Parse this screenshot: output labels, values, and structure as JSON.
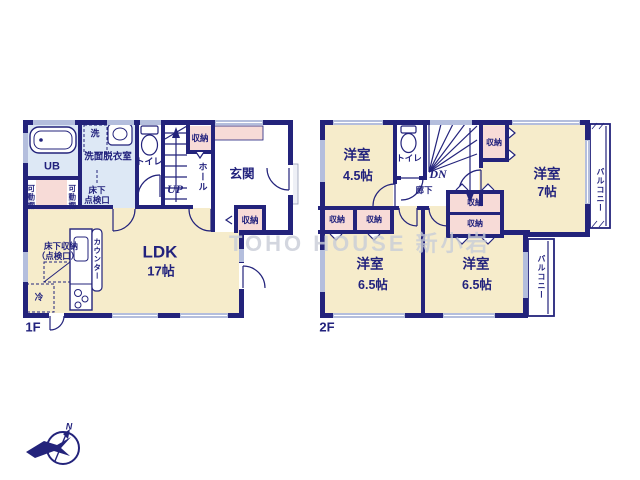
{
  "watermark": "TOHO HOUSE 新小岩",
  "compass": {
    "north": "N"
  },
  "shared": {
    "storage": "収納",
    "balcony": "バルコニー",
    "toilet": "トイレ",
    "western_room": "洋室"
  },
  "floor1": {
    "label": "1F",
    "bath": "UB",
    "washroom": "洗面脱衣室",
    "washer": "洗",
    "underfloor_check_line1": "床下",
    "underfloor_check_line2": "点検口",
    "movable_shelf": "可動棚",
    "hall": "ホール",
    "entrance": "玄関",
    "stairs_up": "UP",
    "ldk_name": "LDK",
    "ldk_size": "17帖",
    "underfloor_storage_line1": "床下収納",
    "underfloor_storage_line2": "（点検口）",
    "refrigerator": "冷",
    "counter": "カウンター"
  },
  "floor2": {
    "label": "2F",
    "corridor": "廊下",
    "stairs_down": "DN",
    "rooms": [
      {
        "name": "洋室",
        "size": "4.5帖"
      },
      {
        "name": "洋室",
        "size": "7帖"
      },
      {
        "name": "洋室",
        "size": "6.5帖"
      },
      {
        "name": "洋室",
        "size": "6.5帖"
      }
    ]
  }
}
